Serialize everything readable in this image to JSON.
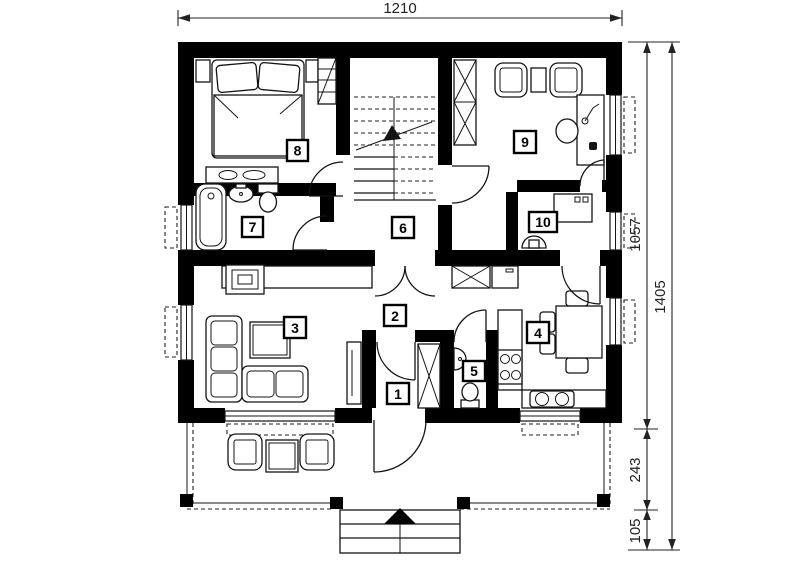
{
  "page": {
    "background": "#ffffff"
  },
  "dimensions": {
    "top": {
      "label": "1210"
    },
    "right_inner": {
      "segments": [
        {
          "label": "1057"
        },
        {
          "label": "243"
        },
        {
          "label": "105"
        }
      ]
    },
    "right_outer": {
      "label": "1405"
    }
  },
  "rooms": [
    {
      "number": "1"
    },
    {
      "number": "2"
    },
    {
      "number": "3"
    },
    {
      "number": "4"
    },
    {
      "number": "5"
    },
    {
      "number": "6"
    },
    {
      "number": "7"
    },
    {
      "number": "8"
    },
    {
      "number": "9"
    },
    {
      "number": "10"
    }
  ],
  "colors": {
    "wall": "#000000",
    "line": "#141414",
    "dim_text": "#222222",
    "background": "#ffffff"
  },
  "furniture_icons": [
    "double-bed",
    "nightstand",
    "shelf-wardrobe",
    "dresser",
    "bathtub",
    "washbasin",
    "toilet",
    "staircase-up-arrow",
    "x-wardrobe",
    "armchair",
    "side-table",
    "desk",
    "desk-chair",
    "desk-lamp",
    "washing-machine",
    "wall-basin",
    "fireplace",
    "sideboard",
    "corner-sofa",
    "coffee-table",
    "tv-panel",
    "built-in-closet",
    "pantry-cabinet",
    "fridge",
    "kitchen-stove",
    "double-sink",
    "dining-table",
    "dining-chair",
    "terrace-armchair",
    "terrace-table",
    "entrance-steps",
    "entrance-arrow"
  ]
}
